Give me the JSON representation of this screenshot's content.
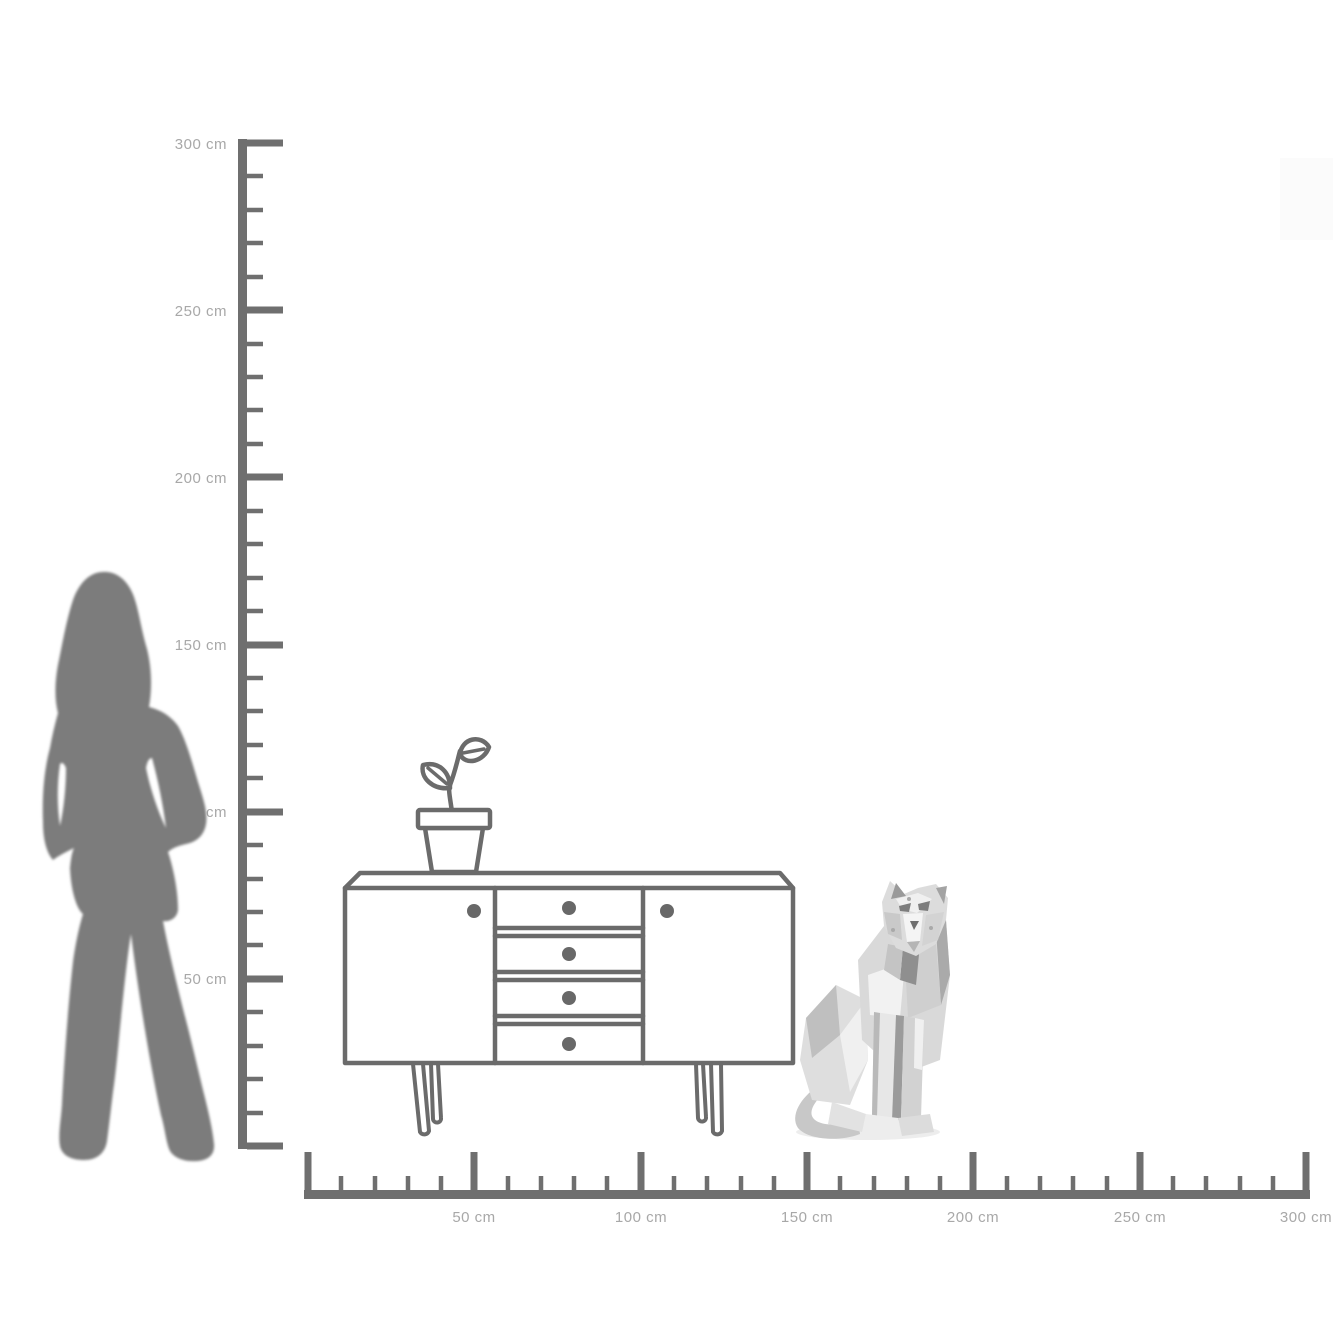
{
  "page": {
    "description": "Furniture size comparison diagram with vertical and horizontal cm rulers",
    "background": "#ffffff"
  },
  "vertical_ruler": {
    "unit": "cm",
    "min": 0,
    "max": 300,
    "major_step_cm": 50,
    "minor_step_cm": 10,
    "labels": [
      "300 cm",
      "250 cm",
      "200 cm",
      "150 cm",
      "100 cm",
      "50 cm"
    ]
  },
  "horizontal_ruler": {
    "unit": "cm",
    "min": 0,
    "max": 300,
    "major_step_cm": 50,
    "minor_step_cm": 10,
    "labels": [
      "50 cm",
      "100 cm",
      "150 cm",
      "200 cm",
      "250 cm",
      "300 cm"
    ]
  },
  "objects": {
    "woman_silhouette": {
      "name": "standing woman silhouette",
      "approx_height_cm": 171
    },
    "sideboard": {
      "name": "sideboard line drawing",
      "doors": 2,
      "drawers": 4,
      "legs": "hairpin",
      "approx_width_cm": 135,
      "approx_height_cm": 80
    },
    "plant": {
      "name": "potted plant line drawing on sideboard top"
    },
    "figurine": {
      "name": "silver faceted sitting panther figurine",
      "approx_height_cm": 78
    }
  },
  "colors": {
    "ruler": "#6f6f6f",
    "ruler_label": "#a8a8a8",
    "line_art": "#6b6b6b",
    "silhouette": "#7b7b7b",
    "figurine_light": "#f2f2f2",
    "figurine_dark": "#8f8f8f"
  }
}
